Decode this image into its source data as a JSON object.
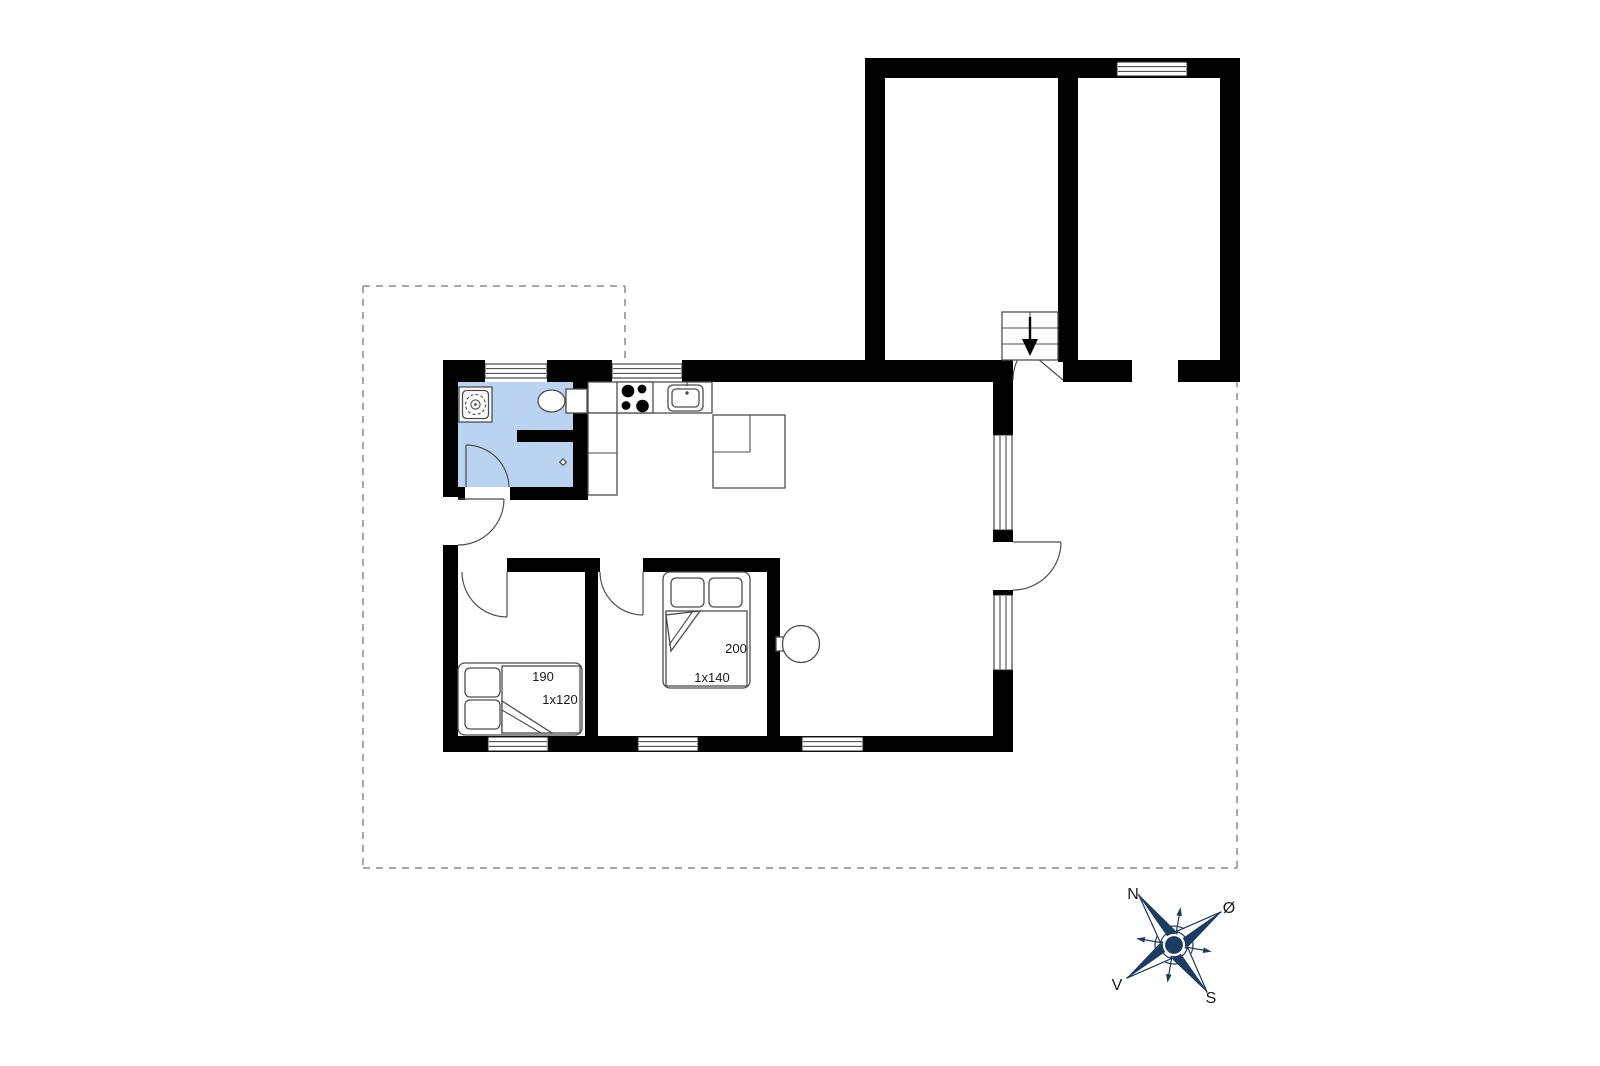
{
  "title": "Floor plan",
  "colors": {
    "wall": "#000000",
    "bathroom": "#b9d3f1",
    "line": "#4d4d4d",
    "dash": "#8a8a8a",
    "compass": "#1d3c60",
    "label": "#1a1a1a"
  },
  "rooms": {
    "bedroom1": {
      "bed_length": "190",
      "bed_width": "1x120"
    },
    "bedroom2": {
      "bed_length": "200",
      "bed_width": "1x140"
    }
  },
  "compass": {
    "north": "N",
    "east": "Ø",
    "west": "V",
    "south": "S"
  }
}
